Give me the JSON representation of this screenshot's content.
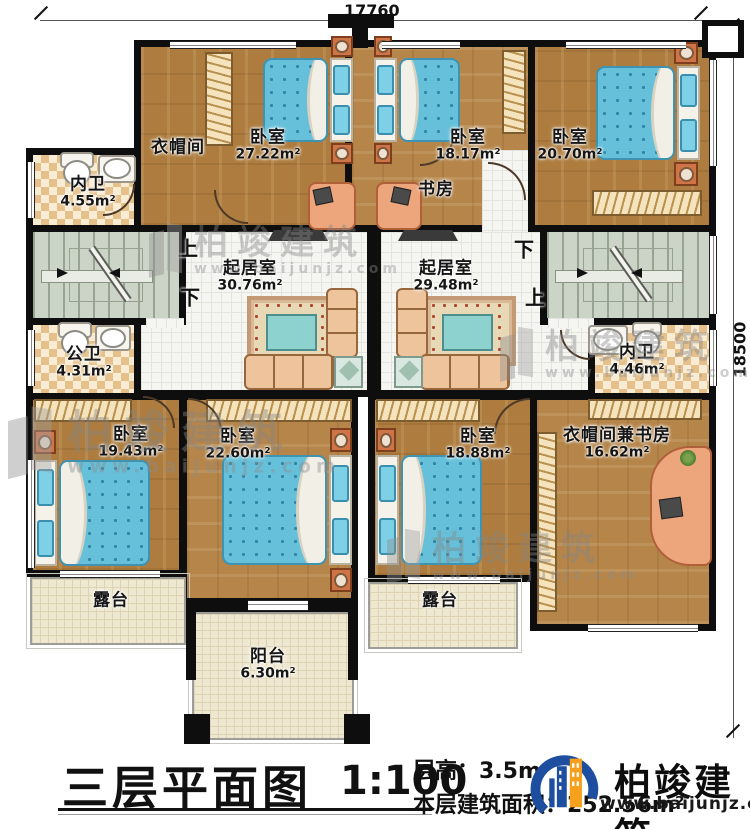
{
  "dimensions": {
    "top": "17760",
    "right": "18500"
  },
  "rooms": [
    {
      "name": "衣帽间",
      "area": ""
    },
    {
      "name": "卧室",
      "area": "27.22m²"
    },
    {
      "name": "内卫",
      "area": "4.55m²"
    },
    {
      "name": "卧室",
      "area": "18.17m²"
    },
    {
      "name": "书房",
      "area": ""
    },
    {
      "name": "卧室",
      "area": "20.70m²"
    },
    {
      "name": "起居室",
      "area": "30.76m²"
    },
    {
      "name": "起居室",
      "area": "29.48m²"
    },
    {
      "name": "公卫",
      "area": "4.31m²"
    },
    {
      "name": "内卫",
      "area": "4.46m²"
    },
    {
      "name": "卧室",
      "area": "19.43m²"
    },
    {
      "name": "卧室",
      "area": "22.60m²"
    },
    {
      "name": "卧室",
      "area": "18.88m²"
    },
    {
      "name": "衣帽间兼书房",
      "area": "16.62m²"
    },
    {
      "name": "露台",
      "area": ""
    },
    {
      "name": "露台",
      "area": ""
    },
    {
      "name": "阳台",
      "area": "6.30m²"
    }
  ],
  "stairs": {
    "left_up": "上",
    "left_down": "下",
    "right_up": "上",
    "right_down": "下"
  },
  "watermark": {
    "brand": "柏竣建筑",
    "url": "www.baijunjz.com"
  },
  "titleblock": {
    "plan_title": "三层平面图",
    "scale": "1:100",
    "floor_height": "层高：3.5m",
    "floor_area": "本层建筑面积：252.56m²"
  },
  "logo": {
    "brand": "柏竣建筑",
    "url": "www.baijunjz.com"
  }
}
